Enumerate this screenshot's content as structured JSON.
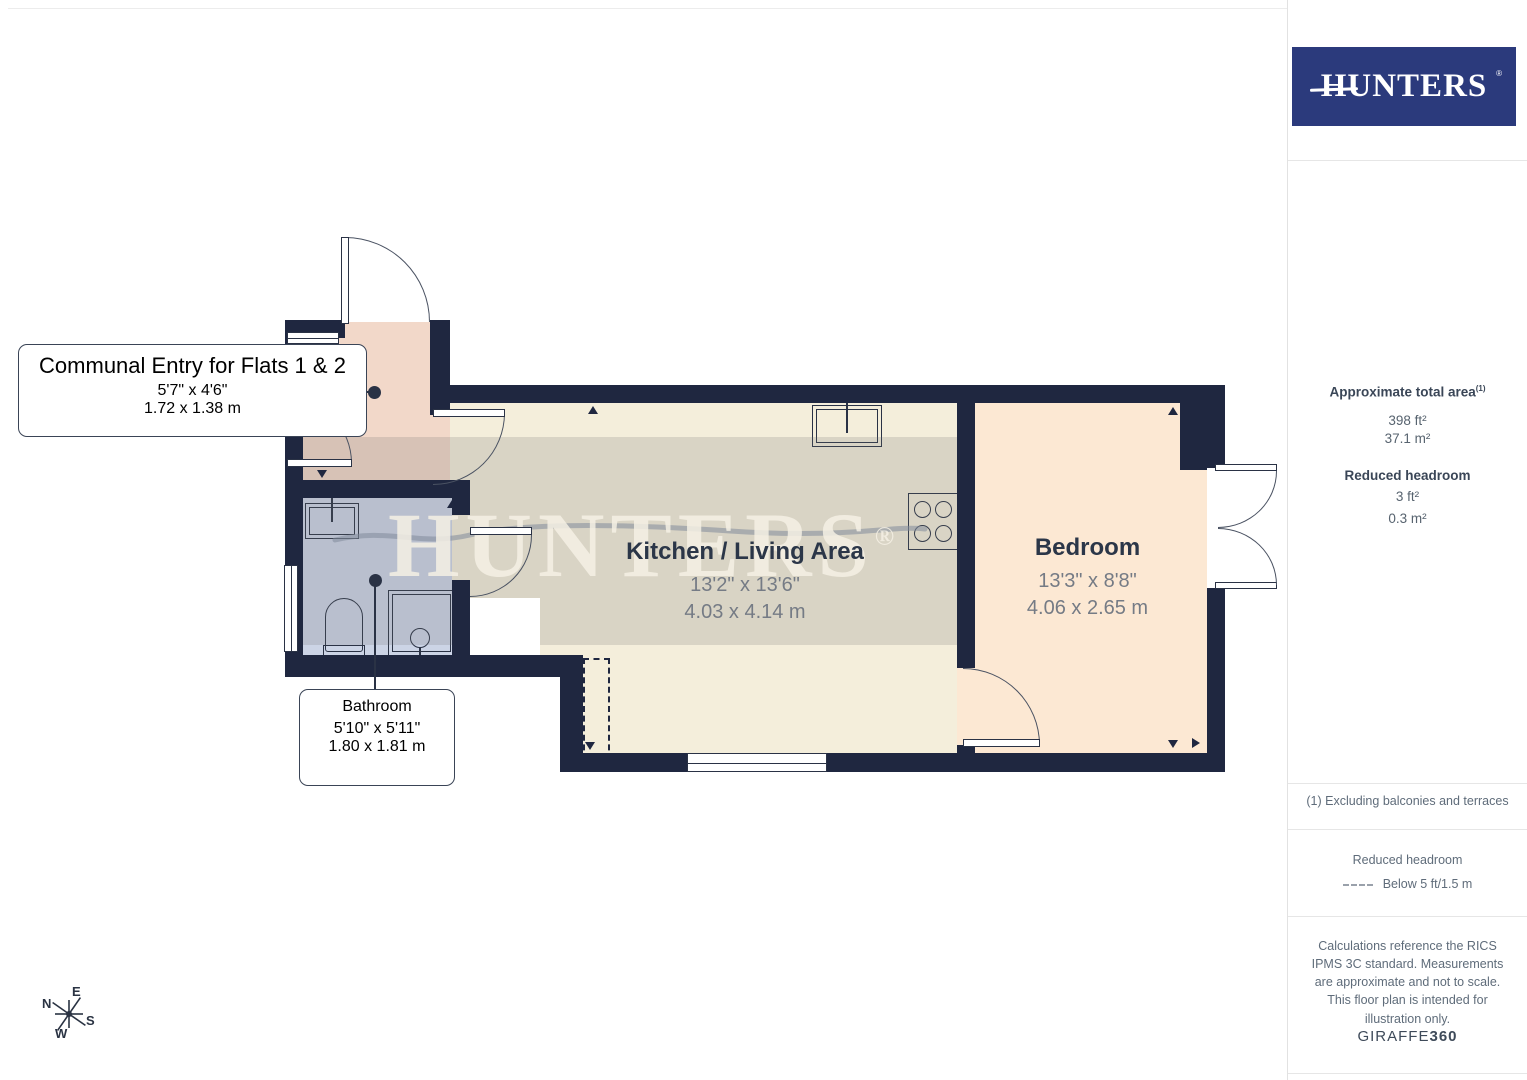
{
  "brand": {
    "logo_text": "HUNTERS",
    "registered": "®",
    "navy": "#2b3a7c"
  },
  "sidebar": {
    "area_heading": "Approximate total area",
    "area_sup": "(1)",
    "area_ft": "398 ft²",
    "area_m": "37.1 m²",
    "headroom_heading": "Reduced headroom",
    "headroom_ft": "3 ft²",
    "headroom_m": "0.3 m²",
    "footnote": "(1) Excluding balconies and terraces",
    "legend_heading": "Reduced headroom",
    "legend_label": "Below 5 ft/1.5 m",
    "disclaimer": "Calculations reference the RICS IPMS 3C standard. Measurements are approximate and not to scale. This floor plan is intended for illustration only.",
    "credit_normal": "GIRAFFE",
    "credit_bold": "360"
  },
  "floorplan": {
    "watermark": "HUNTERS",
    "watermark_reg": "®",
    "wall_color": "#1f2740",
    "rooms": [
      {
        "name": "Communal Entry for Flats 1 & 2",
        "imperial": "5'7\" x 4'6\"",
        "metric": "1.72 x 1.38 m",
        "floor_color": "#f2d8c9"
      },
      {
        "name": "Kitchen / Living Area",
        "imperial": "13'2\" x 13'6\"",
        "metric": "4.03 x 4.14 m",
        "floor_color": "#f4eedb"
      },
      {
        "name": "Bedroom",
        "imperial": "13'3\" x 8'8\"",
        "metric": "4.06 x 2.65 m",
        "floor_color": "#fce8d3"
      },
      {
        "name": "Bathroom",
        "imperial": "5'10\" x 5'11\"",
        "metric": "1.80 x 1.81 m",
        "floor_color": "#ccd4e6"
      }
    ],
    "compass": {
      "n": "N",
      "e": "E",
      "s": "S",
      "w": "W"
    }
  }
}
